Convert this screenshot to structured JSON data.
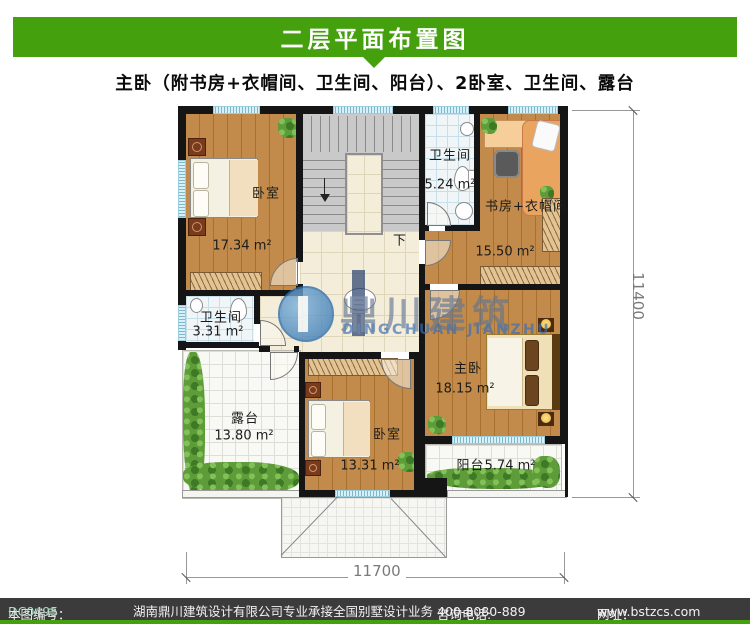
{
  "header": {
    "title": "二层平面布置图",
    "subtitle": "主卧（附书房+衣帽间、卫生间、阳台）、2卧室、卫生间、露台"
  },
  "plan": {
    "rooms": [
      {
        "id": "bedroom-topleft",
        "name": "卧室",
        "area": "17.34 m²"
      },
      {
        "id": "bathroom-top",
        "name": "卫生间",
        "area": "5.24 m²"
      },
      {
        "id": "study-cloakroom",
        "name": "书房+衣帽间",
        "area": "15.50 m²"
      },
      {
        "id": "bathroom-left",
        "name": "卫生间",
        "area": "3.31 m²"
      },
      {
        "id": "terrace",
        "name": "露台",
        "area": "13.80 m²"
      },
      {
        "id": "bedroom-bottom",
        "name": "卧室",
        "area": "13.31 m²"
      },
      {
        "id": "master-bedroom",
        "name": "主卧",
        "area": "18.15 m²"
      },
      {
        "id": "balcony",
        "name": "阳台",
        "area": "5.74 m²"
      }
    ],
    "stairs": {
      "down_label": "下"
    },
    "dimensions": {
      "bottom": "11700",
      "right": "11400"
    }
  },
  "watermark": {
    "logo": "dingchuan-logo",
    "cn": "鼎川建筑",
    "en": "DINGCHUAN JIANZHU"
  },
  "footer": {
    "serial_label": "本图编号：",
    "serial": "DC0495",
    "company": "湖南鼎川建筑设计有限公司专业承接全国别墅设计业务",
    "phone_label": "咨询电话:",
    "phone": "400-8080-889",
    "web_label": "网址：",
    "web": "www.bstzcs.com"
  },
  "colors": {
    "accent_green": "#44A00C",
    "footer_bar": "#3B3B3B",
    "wall": "#151515",
    "serial_color": "#A9DCC0"
  }
}
